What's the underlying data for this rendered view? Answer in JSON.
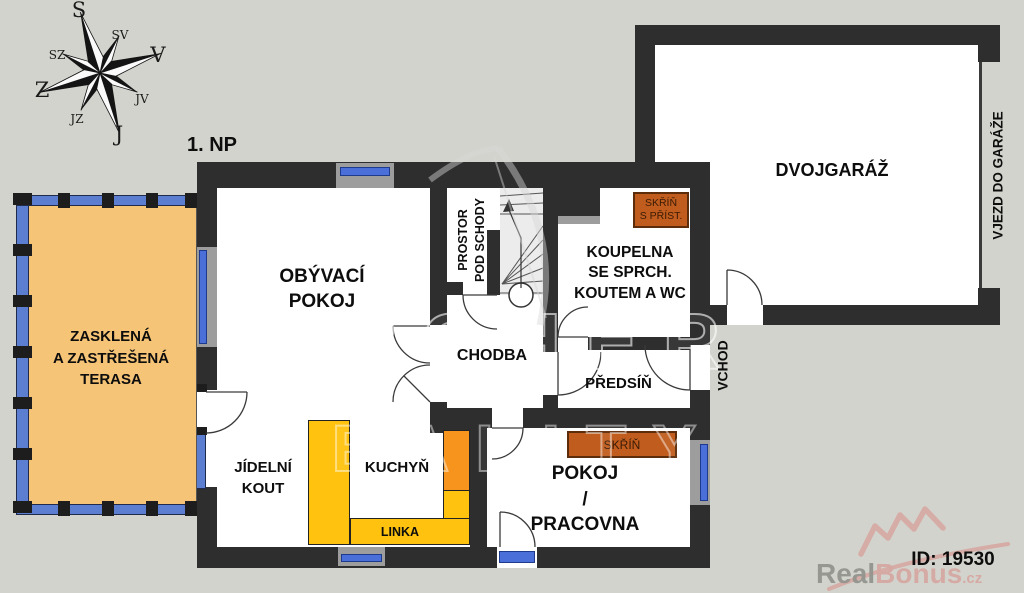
{
  "title": "1. NP",
  "compass": {
    "n": "S",
    "ne": "SV",
    "e": "V",
    "se": "JV",
    "s": "J",
    "sw": "JZ",
    "w": "Z",
    "nw": "SZ"
  },
  "rooms": {
    "terrace": [
      "ZASKLENÁ",
      "A ZASTŘEŠENÁ",
      "TERASA"
    ],
    "living_room": [
      "OBÝVACÍ",
      "POKOJ"
    ],
    "under_stairs": [
      "PROSTOR",
      "POD SCHODY"
    ],
    "bathroom": [
      "KOUPELNA",
      "SE SPRCH.",
      "KOUTEM A WC"
    ],
    "hallway": "CHODBA",
    "entry_hall": "PŘEDSÍŇ",
    "dining": [
      "JÍDELNÍ",
      "KOUT"
    ],
    "kitchen": "KUCHYŇ",
    "kitchen_counter": "LINKA",
    "study": [
      "POKOJ",
      "/",
      "PRACOVNA"
    ],
    "garage": "DVOJGARÁŽ",
    "garage_entry": "VJEZD DO GARÁŽE",
    "entrance": "VCHOD",
    "closet_with_access": [
      "SKŘÍŇ",
      "S PŘÍST."
    ],
    "closet": "SKŘÍŇ"
  },
  "watermark": {
    "line1": "ARCHER",
    "line2": "REALITY"
  },
  "branding": {
    "id_label": "ID: 19530",
    "brand_gray": "Real",
    "brand_pink": "Bonus",
    "brand_suffix": ".cz"
  },
  "colors": {
    "background": "#d3d3cd",
    "wall": "#2e2e2e",
    "floor": "#ffffff",
    "terrace": "#f6c476",
    "glazing": "#5b7ed0",
    "window_glass": "#4a6fd8",
    "window_sill": "#9d9d9d",
    "counter_yellow": "#ffc20e",
    "counter_orange": "#f7941e",
    "wardrobe": "#c05d1e",
    "stairs_fill": "#ececec",
    "logo_pink": "#d6a8a2",
    "logo_gray": "#94948e"
  }
}
